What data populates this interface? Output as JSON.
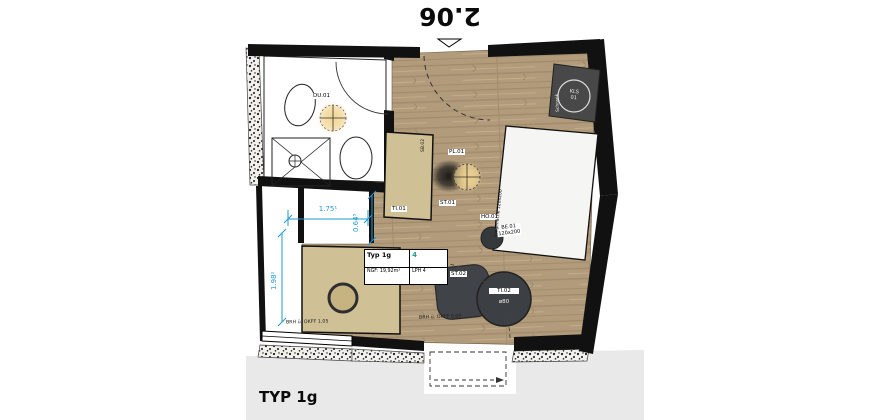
{
  "plan": {
    "title": "TYP 1g",
    "dim_top": "2.06",
    "dims": {
      "niche_width": "1.75¹",
      "niche_depth": "0.64⁵",
      "corridor": "1.98¹"
    },
    "notes": {
      "parapet_left": "BRH ü. OKFF 1.05",
      "parapet_bottom": "BRH ü. OKFF 0.05"
    },
    "info_box": {
      "type": "Typ 1g",
      "area": "NGF: 19,92m²",
      "count": "4",
      "phase": "LPH 4"
    },
    "labels": {
      "pendant_light": "PL.01",
      "bath_light": "DU.01",
      "desk": "TI.01",
      "desk_side": "SB.02",
      "desk_chair": "ST.01",
      "stool": "HO.01",
      "armchair": "ST.02",
      "round_table": "TI.02",
      "round_table_dia": "ø80",
      "bed": "BE.01",
      "bed_size": "120x200",
      "bed_side": "Liegefläche 120x200",
      "wardrobe_line1": "KLS",
      "wardrobe_line2": "01",
      "wardrobe_side": "Schrank"
    },
    "colors": {
      "wood_floor": "#b19b7b",
      "furniture_tan": "#cfc096",
      "furniture_dark": "#3c3f42",
      "wall": "#111111",
      "dimension_blue": "#1e9ad2",
      "count_teal": "#2a9d8f",
      "light_glow": "#f2cf7e",
      "footer_gray": "#e9e9e9"
    }
  }
}
